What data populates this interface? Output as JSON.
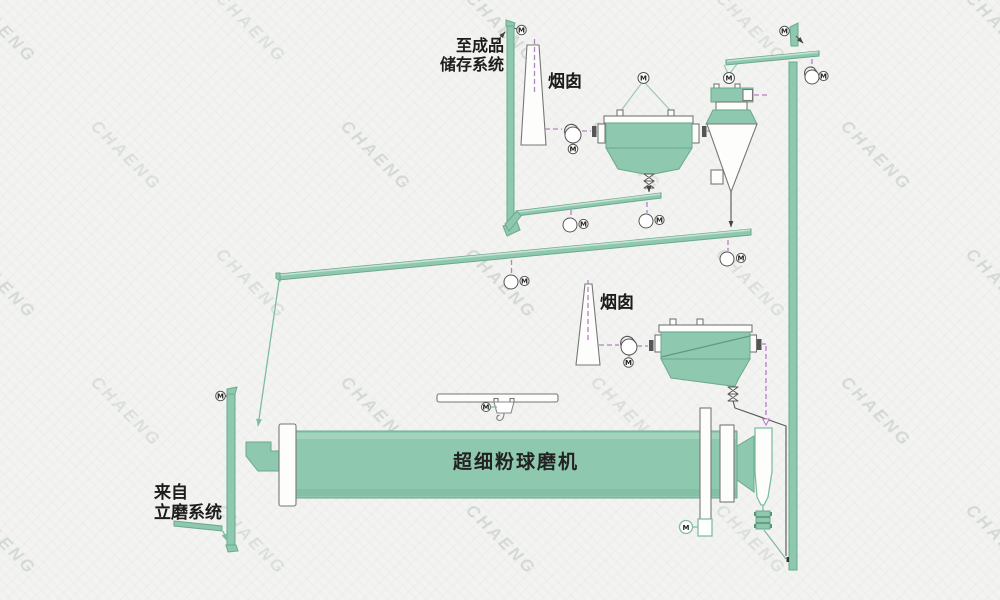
{
  "labels": {
    "to_storage_line1": "至成品",
    "to_storage_line2": "储存系统",
    "chimney_1": "烟囱",
    "chimney_2": "烟囱",
    "ball_mill": "超细粉球磨机",
    "from_vertical_mill_line1": "来自",
    "from_vertical_mill_line2": "立磨系统",
    "motor": "M"
  },
  "watermark": {
    "text": "CHAENG"
  },
  "colors": {
    "equipment_green": "#8ec8ae",
    "outline_green": "#69a98c",
    "light_green_line": "#7fbda1",
    "flow_line_gray": "#555555",
    "air_duct_purple": "#b77fc4",
    "ink": "#1c1c1c",
    "watermark_gray": "#8c9a92",
    "background": "#f3f3f1"
  },
  "icons": {
    "motor": "M-in-circle",
    "exhaust_fan": "volute-fan",
    "air_blower": "circle-with-motor",
    "discharge_valve": "double-flap-valve",
    "crane": "monorail-hoist-with-hook"
  }
}
